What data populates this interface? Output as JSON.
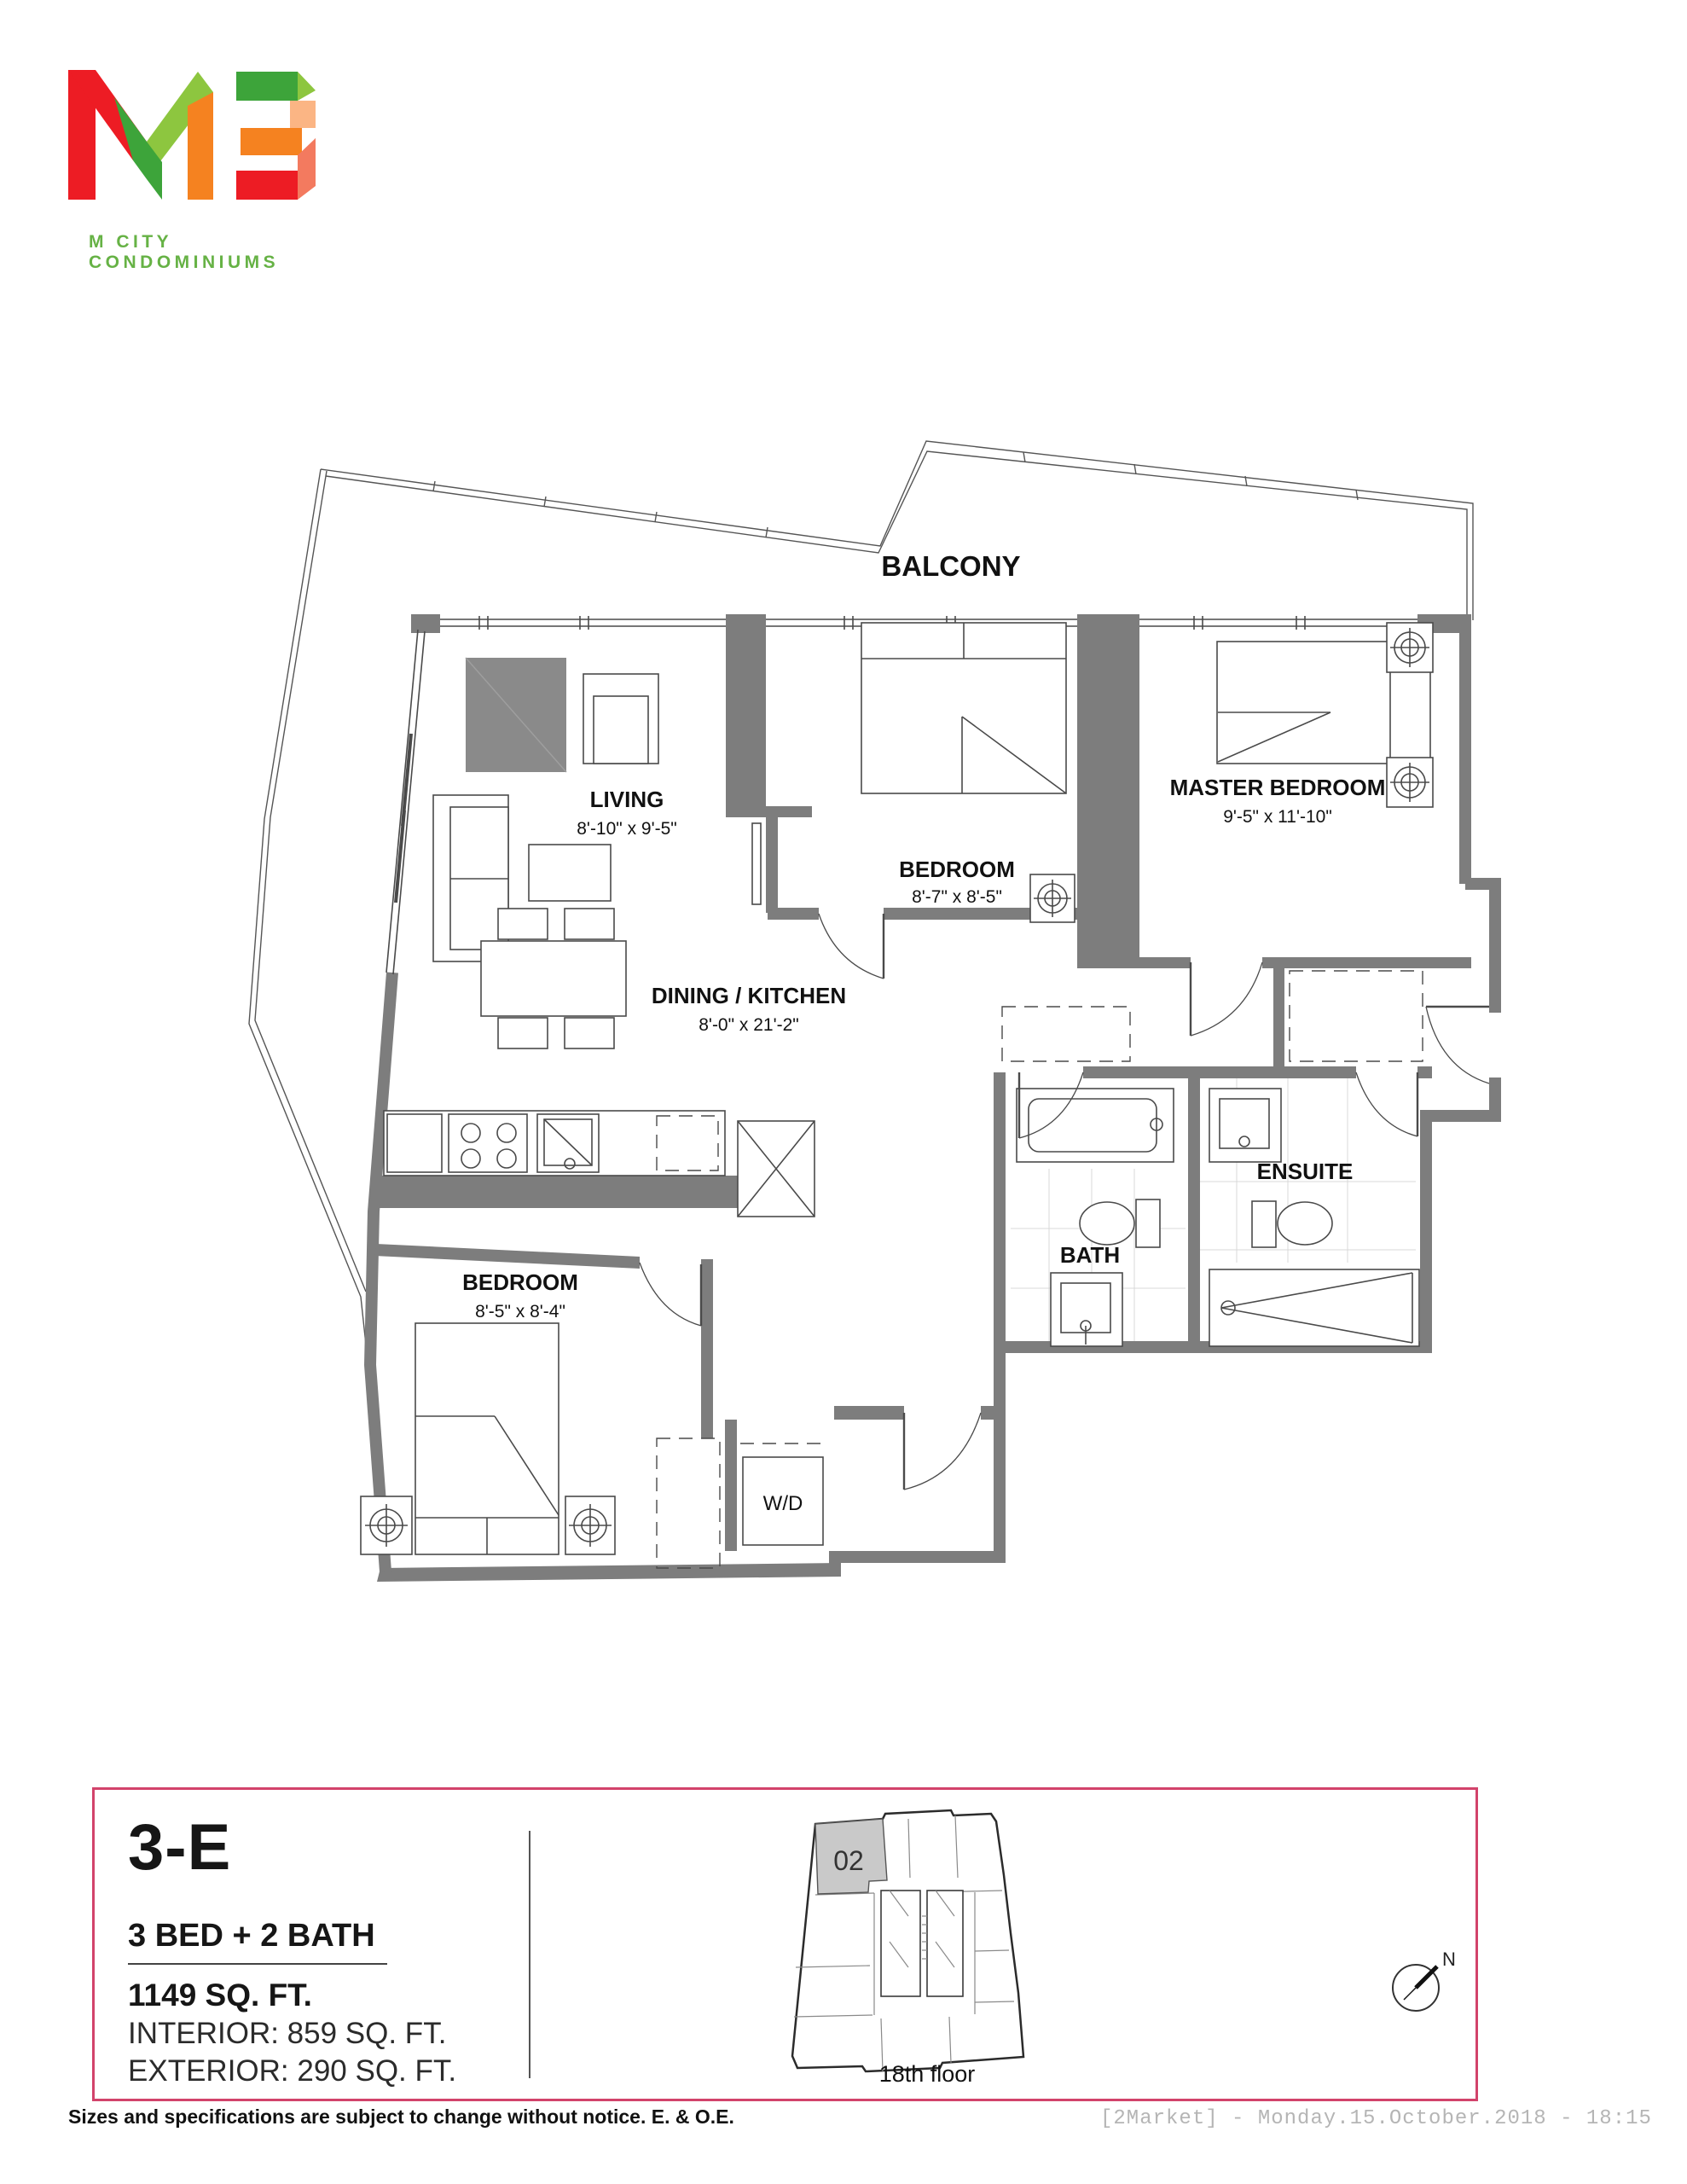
{
  "logo": {
    "brand": "M3",
    "tagline": "M CITY CONDOMINIUMS"
  },
  "plan": {
    "balcony_label": "BALCONY",
    "rooms": {
      "living": {
        "label": "LIVING",
        "dims": "8'-10\" x 9'-5\""
      },
      "bedroom2": {
        "label": "BEDROOM",
        "dims": "8'-7\" x 8'-5\""
      },
      "master": {
        "label": "MASTER BEDROOM",
        "dims": "9'-5\" x 11'-10\""
      },
      "dining_kitchen": {
        "label": "DINING / KITCHEN",
        "dims": "8'-0\" x 21'-2\""
      },
      "bedroom3": {
        "label": "BEDROOM",
        "dims": "8'-5\" x 8'-4\""
      },
      "ensuite": {
        "label": "ENSUITE"
      },
      "bath": {
        "label": "BATH"
      },
      "laundry": {
        "label": "W/D"
      }
    }
  },
  "info": {
    "unit": "3-E",
    "config": "3 BED + 2 BATH",
    "total_area": "1149 SQ. FT.",
    "interior": "INTERIOR:  859 SQ. FT.",
    "exterior": "EXTERIOR:  290 SQ. FT.",
    "keyplan": {
      "unit_number": "02",
      "floor": "18th floor",
      "compass": "N"
    }
  },
  "footer": {
    "disclaimer": "Sizes and specifications are subject to change without notice. E. & O.E.",
    "stamp": "[2Market]  -  Monday.15.October.2018  -  18:15"
  },
  "colors": {
    "accent_pink": "#d2436b",
    "wall_gray": "#7d7d7d",
    "logo_red": "#ed1c24",
    "logo_dark_green": "#3da43a",
    "logo_light_green": "#8dc63f",
    "logo_orange": "#f58220",
    "logo_peach": "#fbb584",
    "logo_dark_red": "#a31e22",
    "logo_salmon": "#f37a5f",
    "tagline_green": "#66b245",
    "stamp_gray": "#b5b5b5"
  }
}
